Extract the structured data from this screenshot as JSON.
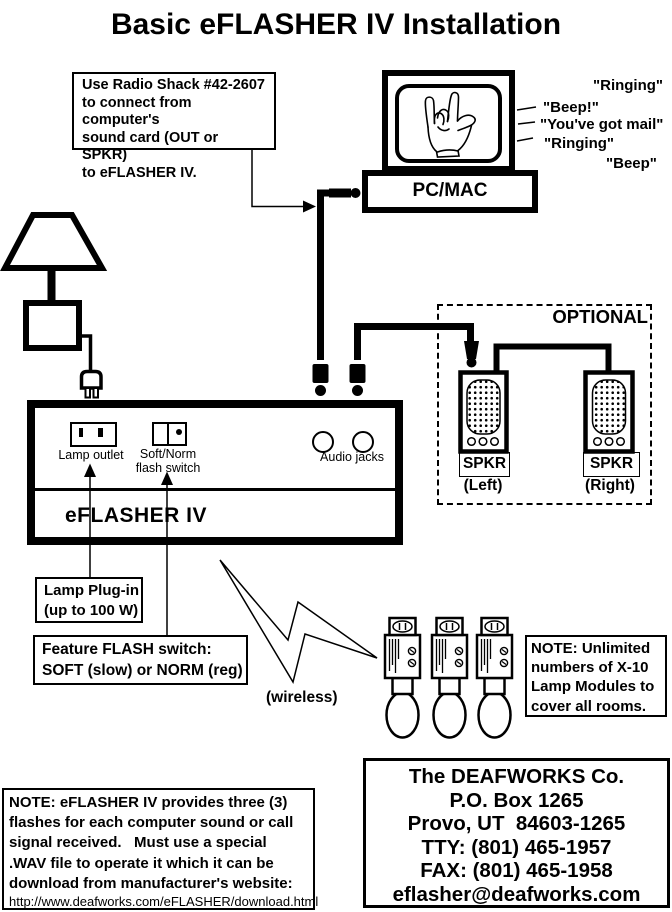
{
  "title": "Basic eFLASHER IV Installation",
  "radio_note": {
    "line1": "Use Radio Shack #42-2607",
    "line2": "to connect from computer's",
    "line3": "sound card (OUT or SPKR)",
    "line4": "to eFLASHER IV."
  },
  "computer": {
    "label": "PC/MAC"
  },
  "sounds": {
    "s1": "\"Ringing\"",
    "s2": "\"Beep!\"",
    "s3": "\"You've got mail\"",
    "s4": "\"Ringing\"",
    "s5": "\"Beep\""
  },
  "optional_box": {
    "title": "OPTIONAL",
    "spkr_left": "SPKR",
    "spkr_left_sub": "(Left)",
    "spkr_right": "SPKR",
    "spkr_right_sub": "(Right)"
  },
  "device": {
    "name": "eFLASHER IV",
    "lamp_outlet": "Lamp outlet",
    "switch_line1": "Soft/Norm",
    "switch_line2": "flash switch",
    "audio_jacks": "Audio jacks"
  },
  "lamp_plugin_note": {
    "line1": "Lamp Plug-in",
    "line2": "(up to 100 W)"
  },
  "flash_switch_note": {
    "line1": "Feature FLASH switch:",
    "line2": "SOFT (slow) or NORM (reg)"
  },
  "wireless_label": "(wireless)",
  "x10_note": {
    "line1": "NOTE: Unlimited",
    "line2": "numbers of X-10",
    "line3": "Lamp Modules to",
    "line4": "cover all rooms."
  },
  "company": {
    "line1": "The DEAFWORKS Co.",
    "line2": "P.O. Box 1265",
    "line3": "Provo, UT  84603-1265",
    "line4": "TTY: (801) 465-1957",
    "line5": "FAX: (801) 465-1958",
    "line6": "eflasher@deafworks.com"
  },
  "bottom_note": {
    "line1": "NOTE: eFLASHER IV provides three (3)",
    "line2": "flashes for each computer sound or call",
    "line3": "signal received.   Must use a special",
    "line4": ".WAV file to operate it which it can be",
    "line5": "download from manufacturer's website:",
    "url": "http://www.deafworks.com/eFLASHER/download.html"
  },
  "colors": {
    "ink": "#000000",
    "paper": "#ffffff"
  }
}
